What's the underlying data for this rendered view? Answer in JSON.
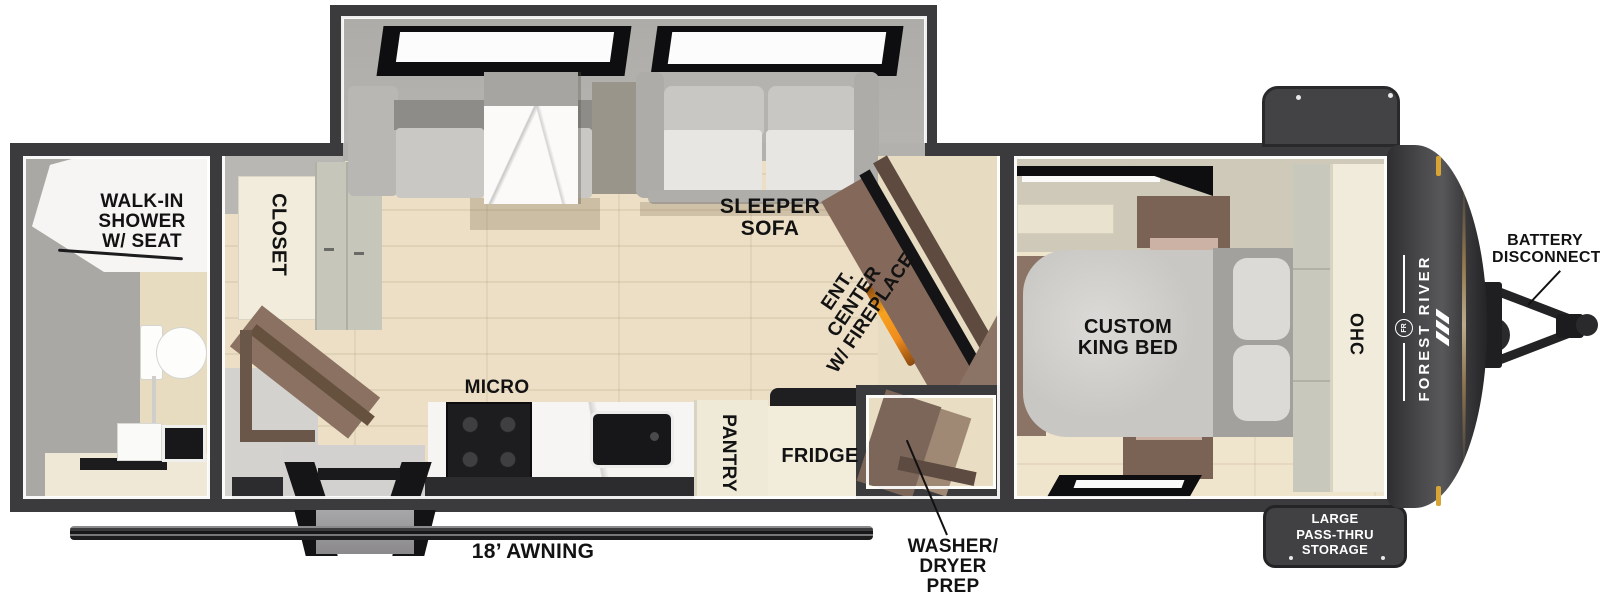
{
  "title": "Travel trailer floorplan",
  "brand": {
    "name": "FOREST RIVER",
    "emblem": "FR"
  },
  "labels": {
    "shower": [
      "WALK-IN",
      "SHOWER",
      "W/ SEAT"
    ],
    "closet": "CLOSET",
    "sleeper_sofa": [
      "SLEEPER",
      "SOFA"
    ],
    "ent_center": [
      "ENT.",
      "CENTER",
      "W/ FIREPLACE"
    ],
    "micro": "MICRO",
    "pantry": "PANTRY",
    "fridge": "FRIDGE",
    "washer_dryer": [
      "WASHER/",
      "DRYER",
      "PREP"
    ],
    "custom_king_bed": [
      "CUSTOM",
      "KING BED"
    ],
    "ohc": "OHC",
    "awning": "18’ AWNING",
    "battery_disconnect": [
      "BATTERY",
      "DISCONNECT"
    ],
    "pass_thru_storage": [
      "LARGE",
      "PASS-THRU",
      "STORAGE"
    ]
  },
  "colors": {
    "wall": "#3b3b3d",
    "floor": "#ecdfc6",
    "cream": "#f1ebdb",
    "slide_gray": "#b3b1ad",
    "fireplace_orange": "#f08c1e",
    "front_cap": "#3a3a3c",
    "marker_gold": "#d8a435",
    "label_text": "#121212"
  }
}
